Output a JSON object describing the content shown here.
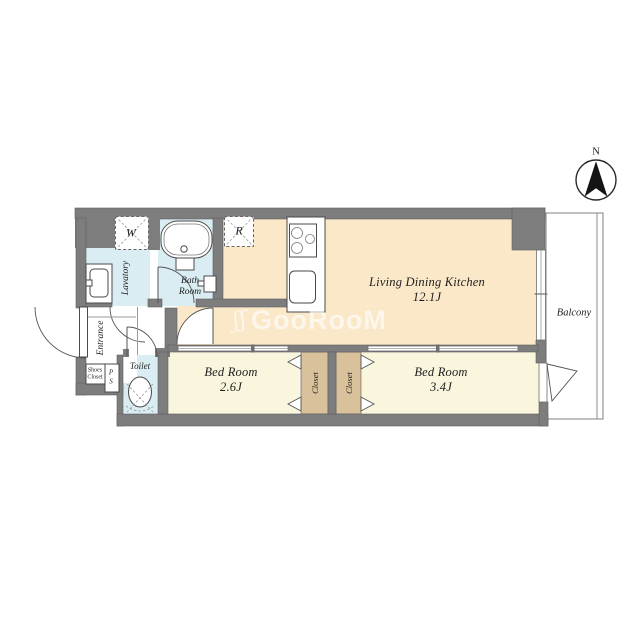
{
  "title": "1LDK apartment floor plan",
  "colors": {
    "wall": "#7d7d7d",
    "ldk_floor": "#fae8c9",
    "bedroom_floor": "#faf6dd",
    "closet_floor": "#d9c29b",
    "wet_area_floor": "#d9edf2",
    "watermark": "rgba(255,255,255,0.62)"
  },
  "compass": {
    "north_label": "N"
  },
  "watermark": {
    "logo": "ʃʃ",
    "text": "GooRooM"
  },
  "rooms": {
    "ldk": {
      "name": "Living Dining Kitchen",
      "size": "12.1J"
    },
    "bedroom1": {
      "name": "Bed Room",
      "size": "2.6J"
    },
    "bedroom2": {
      "name": "Bed Room",
      "size": "3.4J"
    },
    "balcony": {
      "label": "Balcony"
    },
    "bathroom": {
      "label_line1": "Bath",
      "label_line2": "Room"
    },
    "lavatory": {
      "label": "Lavatory"
    },
    "toilet": {
      "label": "Toilet"
    },
    "entrance": {
      "label": "Entrance"
    },
    "shoes_closet": {
      "label": "Shoes Closet"
    },
    "closet1": {
      "label": "Closet"
    },
    "closet2": {
      "label": "Closet"
    },
    "pipe_space": {
      "label": "PS"
    }
  },
  "appliances": {
    "washer_label": "W",
    "refrigerator_label": "R"
  }
}
